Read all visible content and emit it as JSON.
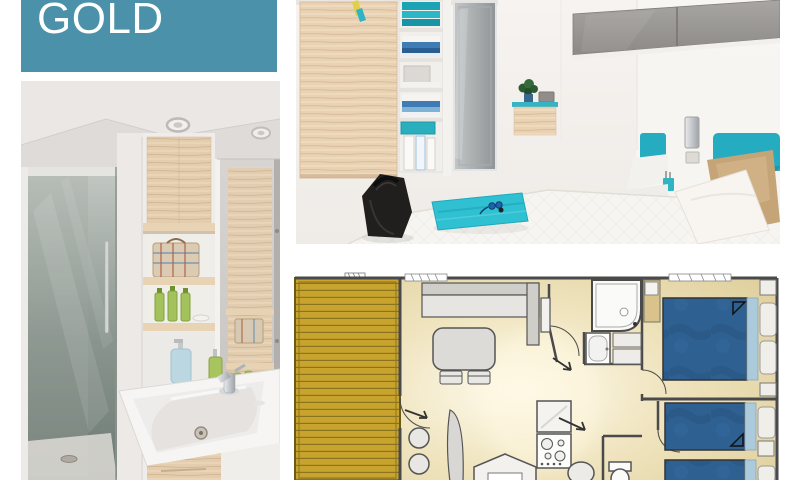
{
  "banner": {
    "label": "GOLD"
  },
  "colors": {
    "page_bg": "#FFFFFF",
    "banner_bg": "#4A91A9",
    "banner_text": "#FFFFFF",
    "accent_teal": "#26ACC0",
    "towel_teal": "#2FC0D2",
    "deck_gold": "#C8A42F",
    "deck_stripe": "#8A741E",
    "plan_wall": "#4A4A4A",
    "plan_floor": "#E2D3A0",
    "bed_blue": "#2E6092",
    "bed_light_blue": "#ABCADC",
    "wood_light": "#E4CDAF"
  },
  "panels": {
    "bathroom_photo": "bathroom with shower cabin, wooden shelves and washbasin",
    "bedroom_photo": "twin bedroom with wardrobe, teal headboards and towels",
    "floor_plan": "mobile home floor plan with terrace, living room, kitchen, bathroom and two bedrooms"
  }
}
